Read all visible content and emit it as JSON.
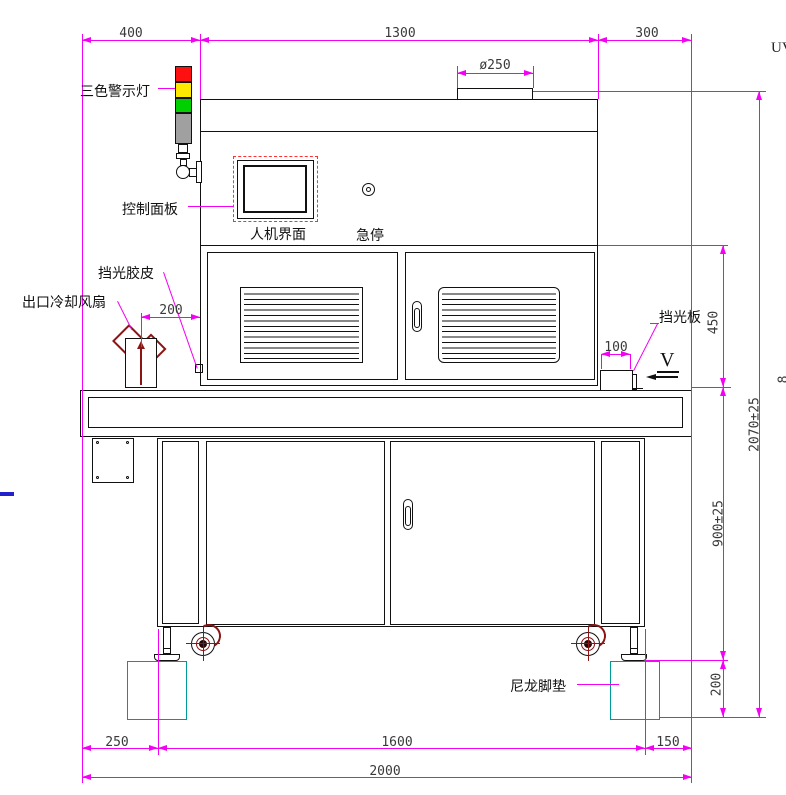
{
  "labels": {
    "warning_light": "三色警示灯",
    "control_panel": "控制面板",
    "hmi": "人机界面",
    "estop": "急停",
    "light_rubber": "挡光胶皮",
    "outlet_fan": "出口冷却风扇",
    "light_plate": "挡光板",
    "nylon_pad": "尼龙脚垫",
    "view_marker": "V",
    "note_uv": "UV",
    "edge_fragment": "8"
  },
  "dims": {
    "left_offset": "400",
    "body_width": "1300",
    "right_offset": "300",
    "duct": "ø250",
    "fan_gap": "200",
    "plate": "100",
    "upper_height": "450",
    "table_height": "900±25",
    "pad_height": "200",
    "total_height": "2070±25",
    "foot_left": "250",
    "wheelbase": "1600",
    "foot_right": "150",
    "total_width": "2000"
  },
  "colors": {
    "dimension_magenta": "#F400F4",
    "structure_black": "#111111",
    "warning_red": "#FF1010",
    "warning_yellow": "#FFE800",
    "warning_green": "#00D000",
    "warning_gray": "#A0A0A0",
    "accent_dark_red": "#8B1414",
    "nylon_pad_teal": "#009999",
    "reference_blue": "#2222CC",
    "panel_dashed_red": "#FF3030"
  }
}
